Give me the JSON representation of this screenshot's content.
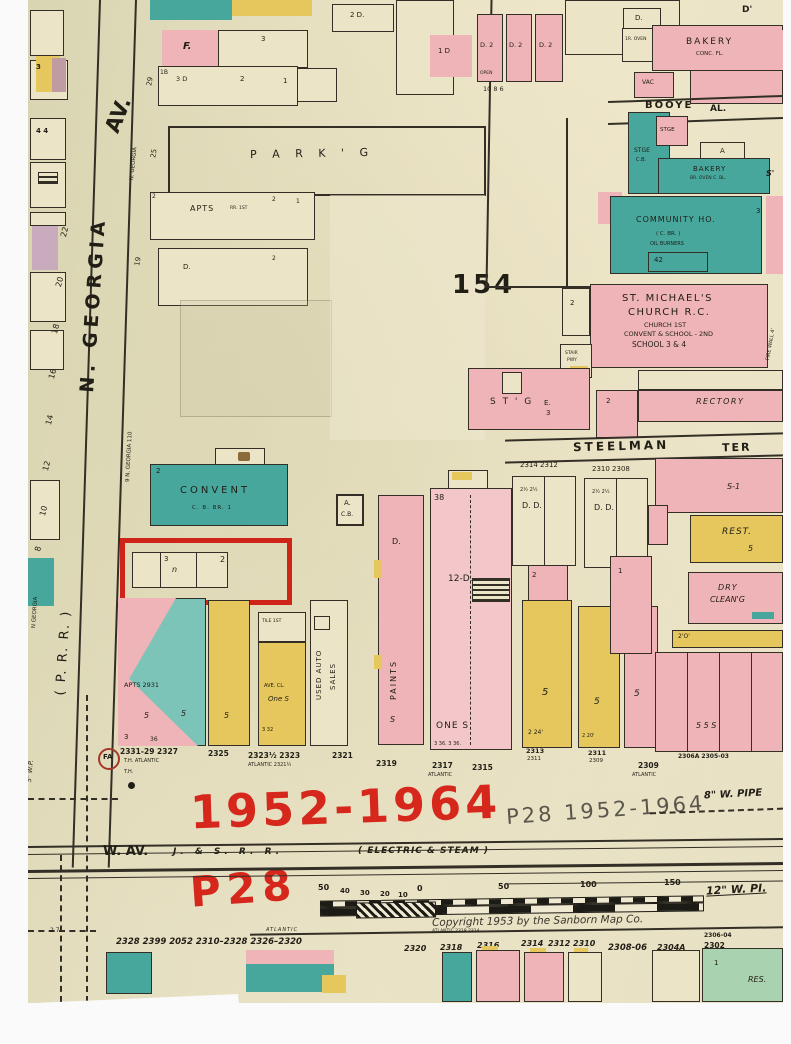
{
  "scan": {
    "plate": "154",
    "copyright": "Copyright 1953 by the Sanborn Map Co."
  },
  "annotations": {
    "red_years": "1952-1964",
    "red_plate": "P28",
    "pencil_note": "P28  1952-1964"
  },
  "streets": {
    "n_georgia": "N. GEORGIA",
    "av": "AV.",
    "n_georgia_small": "N. GEORGIA",
    "n_georgia_9": "9 N. GEORGIA 110",
    "n_georgia_tiny": "N GEORGIA",
    "prr": "( P.  R.  R. )",
    "w_av": "W. AV.",
    "jsrr": "J.  &  S.  R.  R.",
    "electric": "( ELECTRIC  &  STEAM )",
    "steelman": "STEELMAN",
    "ter": "TER",
    "booye": "BOOYE",
    "al": "AL.",
    "atlantic": "ATLANTIC"
  },
  "pipes": {
    "w8": "8\" W. PIPE",
    "w12": "12\" W. PI.",
    "w5": "5\" W.P."
  },
  "scale": {
    "t50l": "50",
    "t40": "40",
    "t30": "30",
    "t20": "20",
    "t10": "10",
    "t0": "0",
    "t50r": "50",
    "t100": "100",
    "t150": "150"
  },
  "buildings": {
    "parkg": "P A R K ' G",
    "apts": "APTS",
    "apts_note": "RR. 1ST",
    "f": "F.",
    "b1": "1B",
    "b3d": "3 D",
    "b2d": "2 D.",
    "d": "D.",
    "d_apo": "D'",
    "one_d": "1 D",
    "d2a": "D. 2",
    "open": "OPEN",
    "row_nums": "10    8    6",
    "bakery1": "BAKERY",
    "conc": "CONC. FL.",
    "oven": "1R. OVEN",
    "vac": "VAC",
    "stge": "STGE",
    "cb": "C.B.",
    "a": "A",
    "s_mark": "S'",
    "bakery2": "BAKERY",
    "bakery2_note": "BR. OVEN  C. BL.",
    "community": "COMMUNITY HO.",
    "community_br": "( C.   BR. )",
    "community_oil": "OIL BURNERS",
    "n42": "42",
    "stm1": "ST. MICHAEL'S",
    "stm2": "CHURCH R.C.",
    "stm3": "CHURCH 1ST",
    "stm4": "CONVENT & SCHOOL - 2ND",
    "stm5": "SCHOOL 3 & 4",
    "stair": "STAIR",
    "pwy": "PWY",
    "firewall": "FIRE WALL 4'",
    "stg": "S T ' G",
    "e": "E.",
    "rectory": "RECTORY",
    "convent": "CONVENT",
    "convent_note": "C. B.  BR.  1",
    "acb_a": "A.",
    "acb_cb": "C.B.",
    "s1": "S-1",
    "rest": "REST.",
    "dry": "DRY",
    "cleang": "CLEAN'G",
    "o2": "2'O'",
    "d12": "12-D.",
    "n38": "38",
    "one_s": "ONE S.",
    "paints": "PAINTS",
    "used1": "USED AUTO",
    "used2": "SALES",
    "tile": "TILE 1ST",
    "ave_cl": "AVE. CL.",
    "one_s2": "One S",
    "apts_sw": "APTS 2931",
    "fa": "FA",
    "th": "T.H.",
    "res": "RES."
  },
  "glyphs": {
    "one": "1",
    "two": "2",
    "three": "3",
    "four": "4  4",
    "five": "5",
    "n": "n",
    "s": "S",
    "n36": "36",
    "d": "D.",
    "dd": "D.        D.",
    "half2": "2½       2½",
    "n24": "2  24'",
    "n20": "2  20'",
    "n332": "3   32",
    "five5": "5      5     S",
    "three36": "3  36.   3  36.",
    "two2": "2",
    "three2": "3",
    "e3": "3"
  },
  "nums": {
    "left": [
      "22",
      "20",
      "18",
      "16",
      "14",
      "12",
      "10",
      "8"
    ],
    "georgia": [
      "29",
      "25",
      "19"
    ],
    "steelman_row": [
      "2314  2312",
      "2310  2308"
    ],
    "atlantic_row": [
      "2331-29  2327",
      "T.H.  ATLANTIC",
      "2325",
      "2323½ 2323",
      "ATLANTIC  2321½",
      "2321",
      "2319",
      "2317",
      "ATLANTIC",
      "2315",
      "2313",
      "2311",
      "2311",
      "2309",
      "2309",
      "ATLANTIC",
      "2306A  2305-03"
    ]
  },
  "bottom": {
    "left_nums": "2328 2399 2052  2310–2328  2326–2320",
    "atl_small": "ATLANTIC",
    "atl_small2": "ATLANTIC    2318     2314",
    "row": [
      "2320",
      "2318",
      "2316",
      "2314",
      "2312  2310",
      "2308-06",
      "2304A",
      "2306-04",
      "2302"
    ],
    "ticks": "2   7"
  }
}
